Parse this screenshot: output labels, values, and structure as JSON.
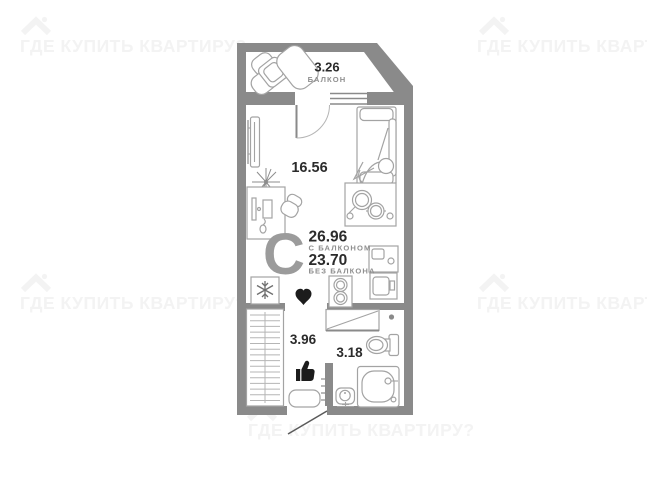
{
  "brand_watermark": {
    "text": "ГДЕ КУПИТЬ КВАРТИРУ?",
    "color": "#f3f3f3"
  },
  "floorplan": {
    "type_letter": "С",
    "rooms": [
      {
        "id": "balcony",
        "area": "3.26",
        "label": "БАЛКОН"
      },
      {
        "id": "living",
        "area": "16.56",
        "label": ""
      },
      {
        "id": "hallway",
        "area": "3.96",
        "label": ""
      },
      {
        "id": "bathroom",
        "area": "3.18",
        "label": ""
      }
    ],
    "totals": {
      "with_balcony_value": "26.96",
      "with_balcony_label": "С БАЛКОНОМ",
      "without_balcony_value": "23.70",
      "without_balcony_label": "БЕЗ БАЛКОНА"
    },
    "colors": {
      "wall": "#8a8a8a",
      "furniture": "#a3a3a3",
      "text_dark": "#2b2b2b",
      "text_gray": "#8f8f8f",
      "letter_gray": "#9b9b9b",
      "icon_black": "#1c1c1c"
    }
  }
}
